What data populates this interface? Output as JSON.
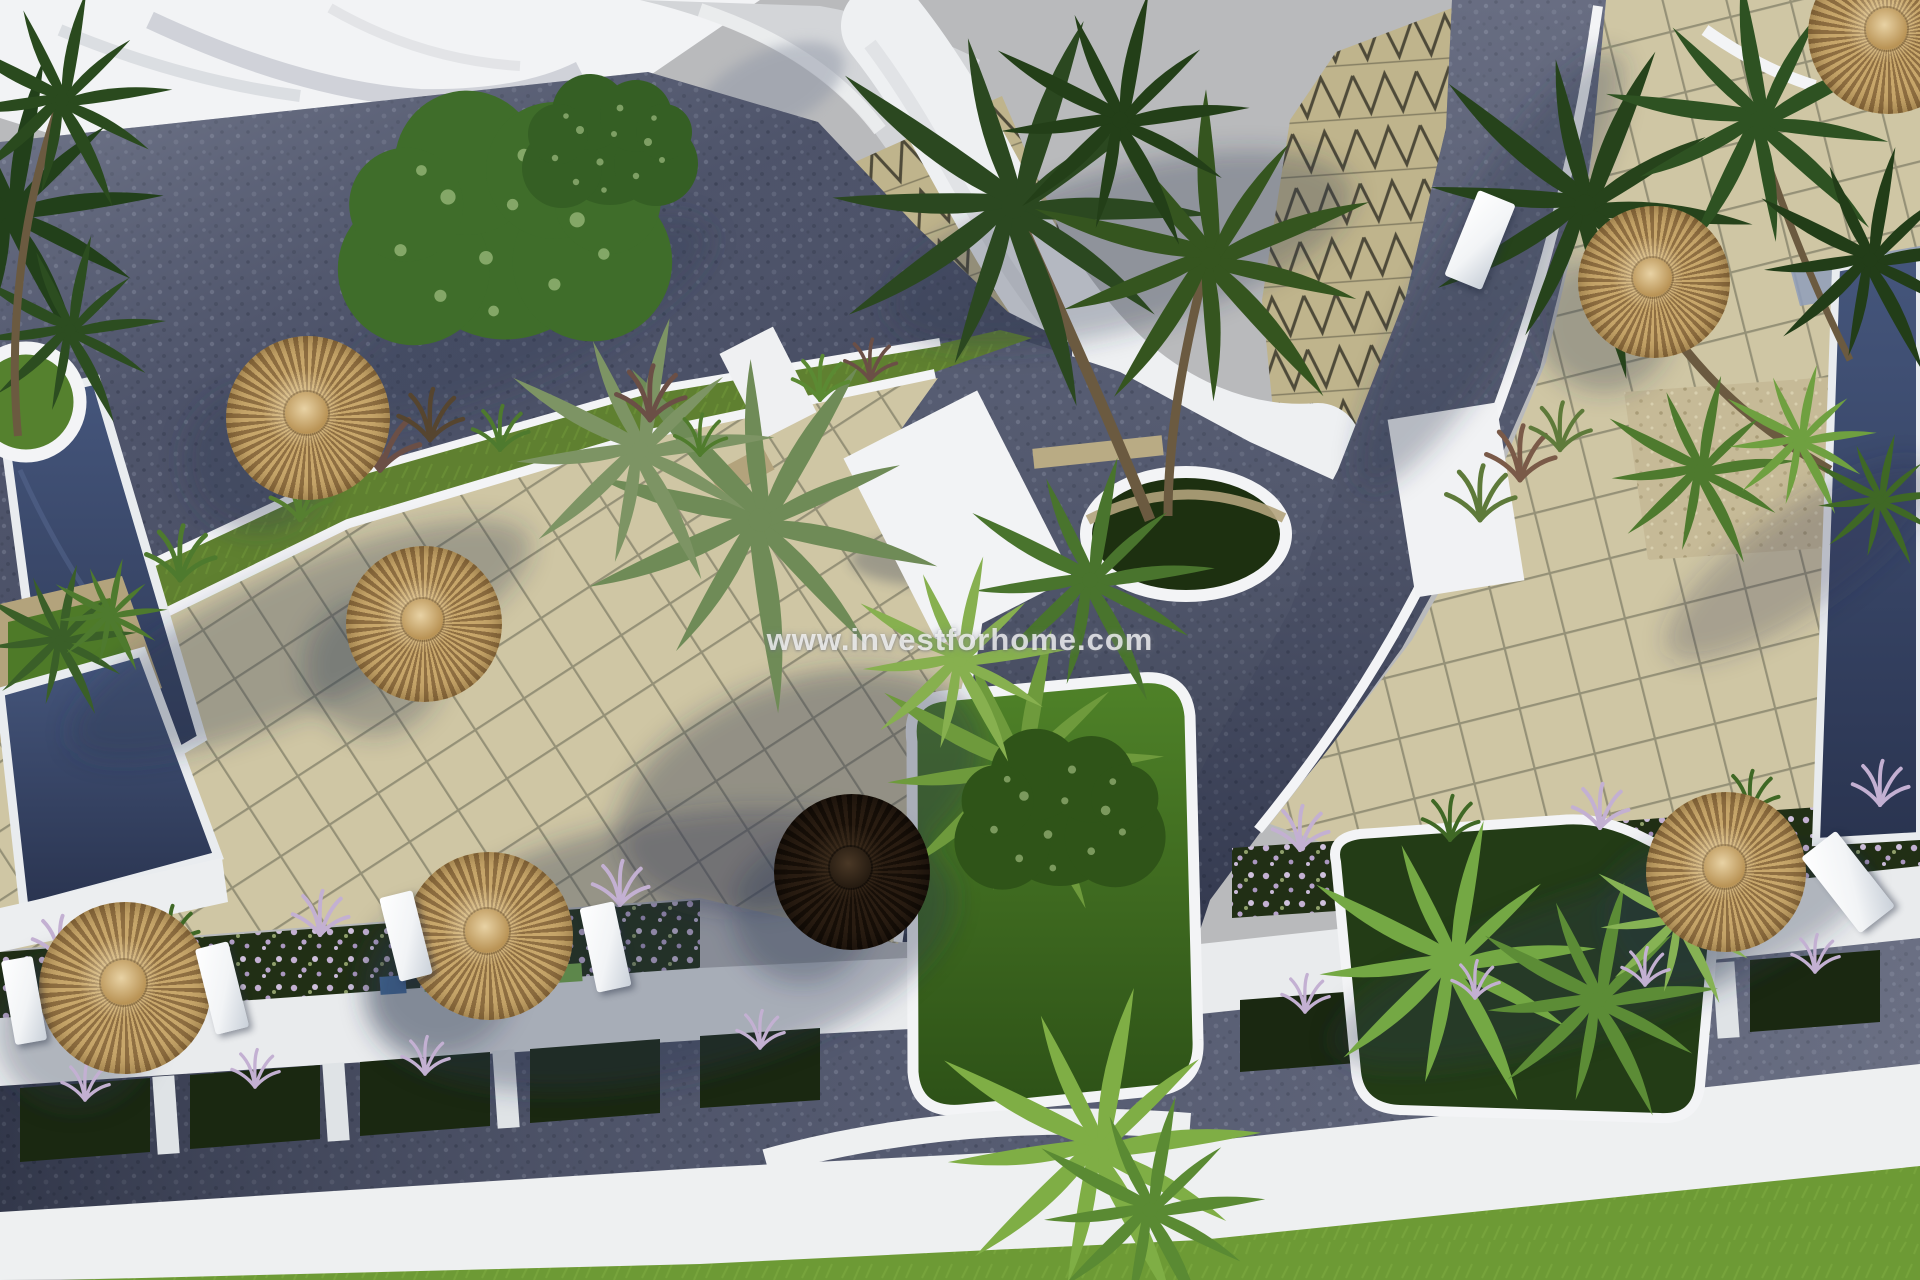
{
  "meta": {
    "kind": "architectural-aerial-render",
    "subject": "resort pool terraces seen from above",
    "width": 1920,
    "height": 1280
  },
  "watermark": {
    "text": "www.investforhome.com"
  },
  "palette": {
    "sky": "#b9babc",
    "building": "#f2f3f5",
    "wall": "#f3f4f6",
    "hedge": "#17220f",
    "road": "#454b62",
    "road-light": "#7b8195",
    "road-dark": "#343a4f",
    "tile": "#cfc6a4",
    "tile-line": "#5c5b49",
    "zig-base": "#bfb48c",
    "zig-line": "#4e4a39",
    "lawn": "#5f8030",
    "lawn-bright": "#6d9a35",
    "island-a": "#4f8228",
    "island-b": "#2d5117",
    "pool-a": "#45567c",
    "pool-b": "#2a3450",
    "pool-edge": "#e9ecef",
    "stone": "#b3a37c",
    "gravel": "#c6ba97",
    "trunk": "#6b5a40",
    "shadow": "#2b3550",
    "umb-straw-a": "#c8a76b",
    "umb-straw-b": "#8f6f42",
    "umb-dark-a": "#2a1d12",
    "umb-dark-b": "#170f08",
    "lounger": "#f4f6f8",
    "flower": "#c3b0d2",
    "palm-dark": "#2b4820",
    "palm-mid": "#4d7a2c",
    "palm-light": "#79a844",
    "tree": "#3f6d2a",
    "sidewalk": "#eef0f1"
  },
  "inventory": {
    "pools": 3,
    "straw_parasols": 7,
    "dark_parasols": 1,
    "sun_loungers": 6
  }
}
